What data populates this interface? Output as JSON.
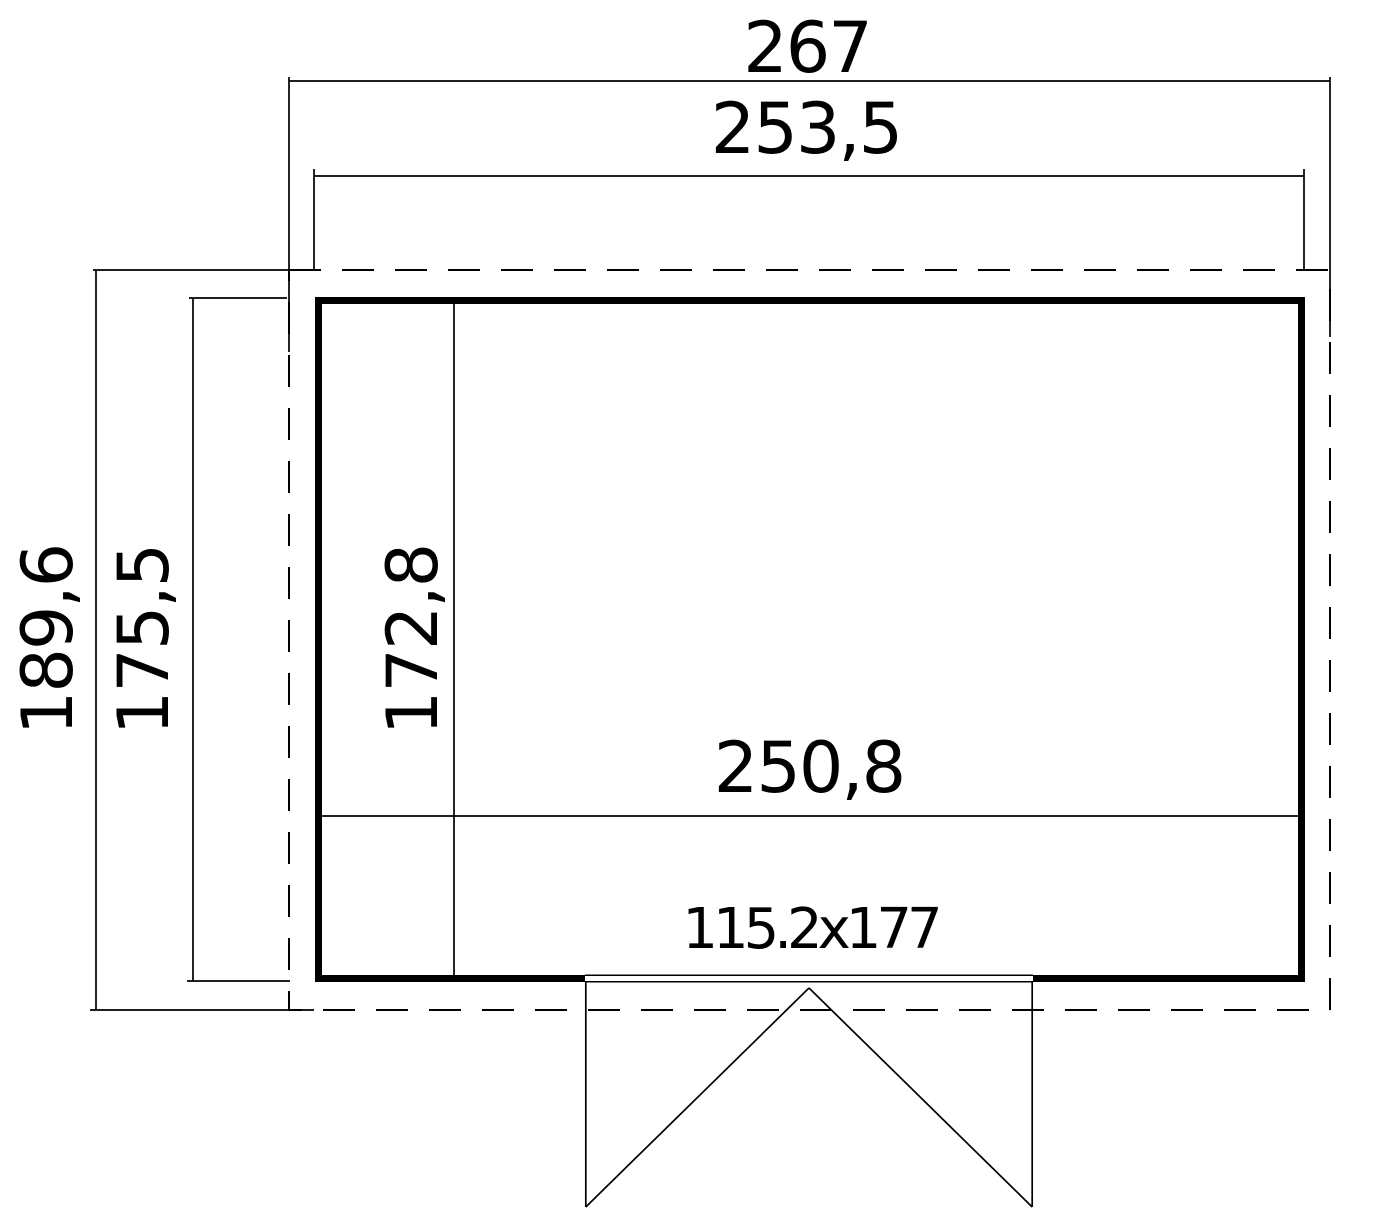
{
  "drawing": {
    "type": "floor-plan",
    "dimensions": {
      "roof_width": "267",
      "wall_outer_width": "253,5",
      "roof_depth": "189,6",
      "wall_outer_depth": "175,5",
      "inner_depth": "172,8",
      "inner_width": "250,8",
      "door_size": "115.2x177"
    },
    "colors": {
      "line": "#000000",
      "background": "#ffffff"
    }
  }
}
